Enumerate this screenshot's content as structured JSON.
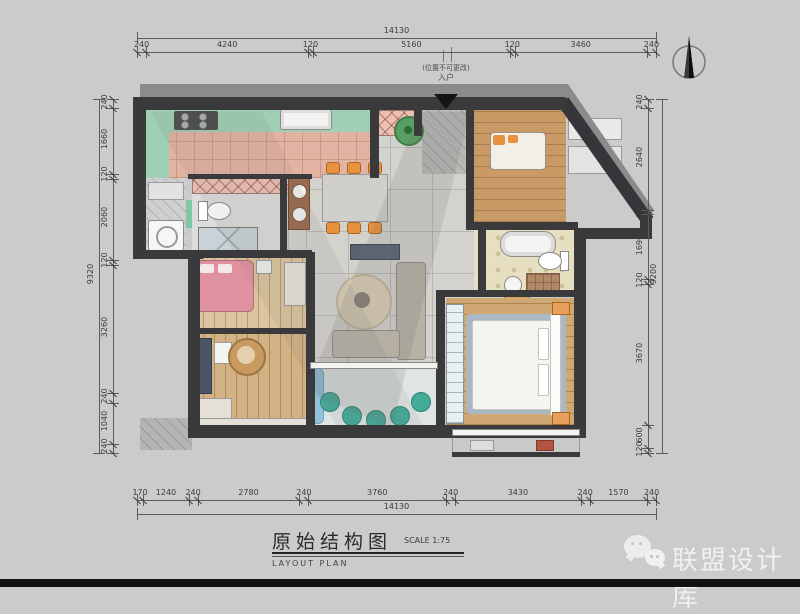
{
  "palette": {
    "background": "#cbcbcb",
    "wall": "#3a3a3d",
    "shadow": "#8b8b8b",
    "marble_floor": "#d4d2cd",
    "kitchen_floor": "#e2b3a2",
    "counter_green": "#9fd0b5",
    "wood_floor": "#cfa873",
    "accent_orange": "#e8923f",
    "bed_pink": "#e0919f",
    "plant_teal": "#43ab97",
    "water_blue": "#92c3da"
  },
  "dimensions": {
    "top": {
      "total": "14130",
      "segments": [
        "240",
        "4240",
        "120",
        "5160",
        "120",
        "3460",
        "240"
      ]
    },
    "bottom": {
      "total": "14130",
      "segments": [
        "170",
        "1240",
        "240",
        "2780",
        "240",
        "3760",
        "240",
        "3430",
        "240",
        "1570",
        "240"
      ]
    },
    "left": {
      "total": "9320",
      "segments": [
        "240",
        "1660",
        "120",
        "2060",
        "120",
        "3260",
        "240",
        "1040",
        "240"
      ]
    },
    "right": {
      "total": "9200",
      "segments": [
        "240",
        "2640",
        "120",
        "1690",
        "120",
        "3670",
        "600",
        "120"
      ]
    }
  },
  "entry": {
    "note": "(位置不可更改)",
    "label": "入户"
  },
  "title_block": {
    "title": "原始结构图",
    "subtitle": "LAYOUT  PLAN",
    "scale": "SCALE 1:75"
  },
  "watermark": {
    "text": "联盟设计库"
  }
}
